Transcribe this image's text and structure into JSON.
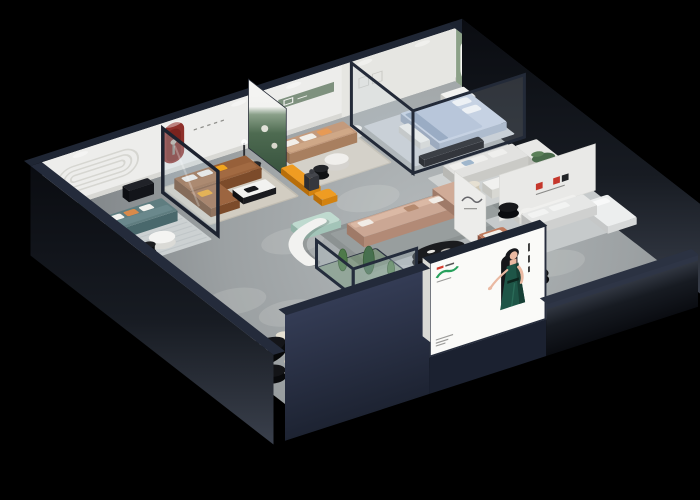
{
  "scene": {
    "title": "furniture-showroom-isometric-render",
    "description": "Isometric cutaway 3D render of a furniture showroom with multiple room vignettes on a black background",
    "background": "#000000",
    "palette": {
      "floor": "#9ca1a3",
      "floor_light": "#b4b9bb",
      "wall_interior": "#ededeb",
      "wall_interior_2": "#e8e8e6",
      "wall_cap": "#232a3a",
      "wall_exterior": "#2b3244",
      "slab_dark": "#0a0c11",
      "accent_red": "#8e2f2a",
      "accent_red_dark": "#7c2822",
      "accent_orange": "#ef9c22",
      "green_wall": "#8ca188",
      "forest": "#4e6b51",
      "sofa_teal": "#5f7d80",
      "sofa_brown": "#97603a",
      "sofa_tan": "#c39a7c",
      "sofa_blush": "#cba794",
      "sofa_terracotta": "#c07a5c",
      "mint": "#bfdacf",
      "bed_blue": "#c5d1e3",
      "ottoman_blue": "#7f99a7",
      "table_black": "#1a1b1e",
      "white_furniture": "#f0efec",
      "rug_light": "#d2cdc2",
      "rug_cool": "#c9cfd5",
      "rug_blue": "#b7c4cd",
      "glass_frame": "#1d2330",
      "poster_bg": "#fafaf8",
      "poster_dress": "#1e5547",
      "poster_skin": "#eab9a2",
      "poster_hair": "#15161a",
      "logo_green": "#27a05c",
      "logo_red": "#d43c2e",
      "pillow_yellow": "#f2a51e",
      "cream": "#e6e0d2"
    },
    "rooms": [
      "living-room-teal-sofa",
      "living-room-brown-leather-sofa",
      "living-room-tan-sofa",
      "bedroom-blue-bed",
      "gallery-green-arched-wall",
      "lounge-right-white-sofas",
      "dining-area-front",
      "center-lounge-sectional",
      "cactus-terrarium",
      "front-display-benches"
    ],
    "poster": {
      "subject": "illustrated hostess in dark green dress",
      "colors": [
        "#1e5547",
        "#27a05c",
        "#d43c2e"
      ]
    }
  }
}
